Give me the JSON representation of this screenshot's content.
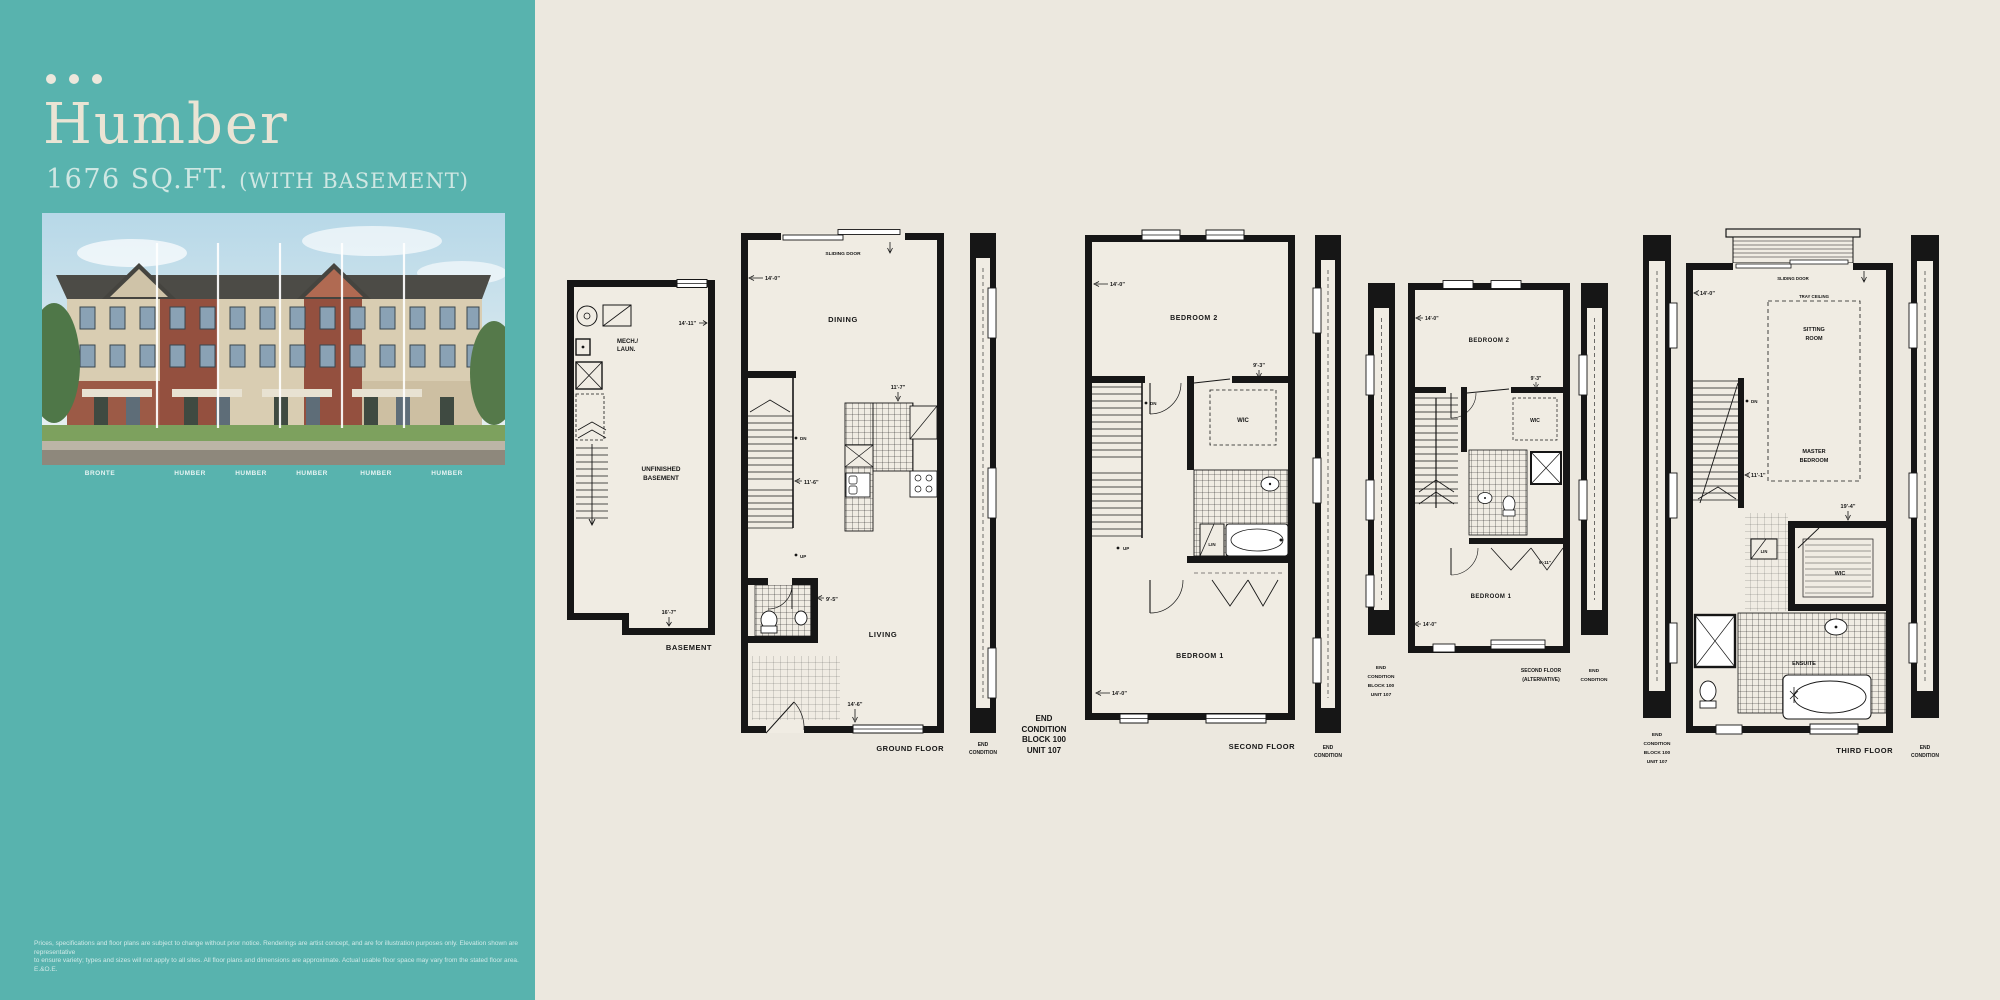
{
  "sidebar": {
    "title": "Humber",
    "sqft": "1676 SQ.FT.",
    "basement_note": "(WITH BASEMENT)",
    "unit_labels": [
      "BRONTE",
      "HUMBER",
      "HUMBER",
      "HUMBER",
      "HUMBER",
      "HUMBER"
    ],
    "disclaimer": [
      "Prices, specifications and floor plans are subject to change without prior notice. Renderings are artist concept, and are for illustration purposes only. Elevation shown are representative",
      "to ensure variety; types and sizes will not apply to all sites. All floor plans and dimensions are approximate. Actual usable floor space may vary from the stated floor area. E.&O.E."
    ]
  },
  "plans": {
    "basement": {
      "caption": "BASEMENT",
      "mech": [
        "MECH./",
        "LAUN."
      ],
      "room": [
        "UNFINISHED",
        "BASEMENT"
      ],
      "dim_top": "14'-11\"",
      "dim_bottom": "16'-7\""
    },
    "ground": {
      "caption": "GROUND FLOOR",
      "sliding_door": "SLIDING DOOR",
      "dining": "DINING",
      "living": "LIVING",
      "dn": "DN",
      "up": "UP",
      "dim_top": "14'-0\"",
      "dim_kitchen": "11'-7\"",
      "dim_stair": "11'-6\"",
      "dim_powder": "9'-5\"",
      "dim_bottom": "14'-6\"",
      "end_condition": [
        "END",
        "CONDITION"
      ]
    },
    "unit_note": [
      "END",
      "CONDITION",
      "BLOCK 100",
      "UNIT 107"
    ],
    "second": {
      "caption": "SECOND FLOOR",
      "bedroom2": "BEDROOM 2",
      "bedroom1": "BEDROOM 1",
      "wic": "WIC",
      "lin": "LIN",
      "dn": "DN",
      "up": "UP",
      "dim_top": "14'-0\"",
      "dim_wic": "9'-3\"",
      "dim_bottom": "14'-0\"",
      "end_condition": [
        "END",
        "CONDITION"
      ]
    },
    "second_alt": {
      "caption": [
        "SECOND FLOOR",
        "(ALTERNATIVE)"
      ],
      "bedroom2": "BEDROOM 2",
      "bedroom1": "BEDROOM 1",
      "wic": "WIC",
      "dim_top": "14'-0\"",
      "dim_wic": "9'-3\"",
      "dim_closet": "9'-11\"",
      "dim_bottom": "14'-0\"",
      "unit_note": [
        "END",
        "CONDITION",
        "BLOCK 100",
        "UNIT 107"
      ],
      "end_condition": [
        "END",
        "CONDITION"
      ]
    },
    "third": {
      "caption": "THIRD FLOOR",
      "sliding_door": "SLIDING DOOR",
      "tray_ceiling": "TRAY CEILING",
      "sitting": [
        "SITTING",
        "ROOM"
      ],
      "master": [
        "MASTER",
        "BEDROOM"
      ],
      "wic": "WIC",
      "lin": "LIN",
      "ensuite": "ENSUITE",
      "dn": "DN",
      "dim_top": "14'-0\"",
      "dim_mid": "11'-1\"",
      "dim_right": "19'-4\"",
      "unit_note": [
        "END",
        "CONDITION",
        "BLOCK 100",
        "UNIT 107"
      ],
      "end_condition": [
        "END",
        "CONDITION"
      ]
    }
  },
  "colors": {
    "sidebar_teal": "#58b3ae",
    "page_cream": "#ece8df",
    "plan_wall": "#161616",
    "plan_floor": "#f0ece3"
  }
}
